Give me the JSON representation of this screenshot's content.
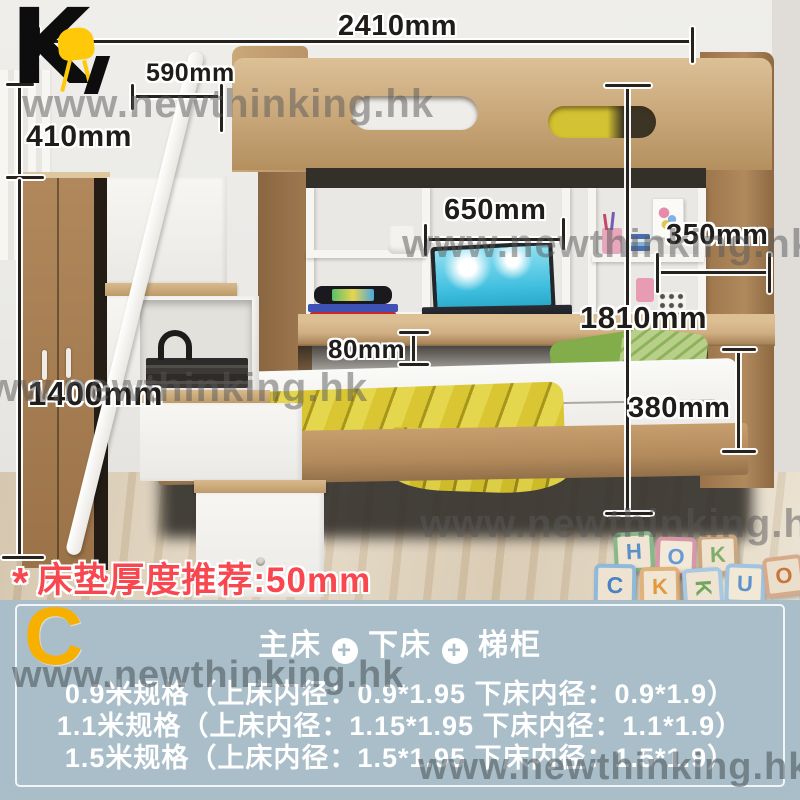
{
  "logo": {
    "letter": "K",
    "chair_icon": "yellow-chair-icon",
    "letter_color": "#0d0d0d",
    "chair_color": "#ffc808"
  },
  "watermark": {
    "text": "www.newthinking.hk",
    "color": "#585858"
  },
  "dimensions": {
    "total_width": "2410mm",
    "stair_depth": "590mm",
    "top_section_height": "410mm",
    "wardrobe_height": "1400mm",
    "desk_depth": "650mm",
    "shelf_depth": "350mm",
    "overall_height": "1810mm",
    "desk_thickness": "80mm",
    "lower_bed_clearance": "380mm"
  },
  "note": {
    "star": "*",
    "text": "床垫厚度推荐:50mm",
    "color": "#f8474e"
  },
  "panel": {
    "bg_color": "#a9bec9",
    "variant_letter": "C",
    "variant_color": "#f8b000",
    "header": {
      "items": [
        "主床",
        "下床",
        "梯柜"
      ],
      "plus": "+"
    },
    "specs": [
      "0.9米规格（上床内径：0.9*1.95 下床内径：0.9*1.9）",
      "1.1米规格（上床内径：1.15*1.95 下床内径：1.1*1.9）",
      "1.5米规格（上床内径：1.5*1.95 下床内径：1.5*1.9）"
    ]
  },
  "blocks": [
    {
      "letter": "H",
      "x": 614,
      "y": 532,
      "size": 40,
      "face": "#f0e5d2",
      "frame": "#86b889",
      "ink": "#5b8fc7",
      "rot": -3
    },
    {
      "letter": "O",
      "x": 656,
      "y": 537,
      "size": 40,
      "face": "#f3e9d8",
      "frame": "#d897a6",
      "ink": "#659bd4",
      "rot": 2
    },
    {
      "letter": "K",
      "x": 698,
      "y": 535,
      "size": 40,
      "face": "#efe3cf",
      "frame": "#caa77e",
      "ink": "#7fae6a",
      "rot": -2
    },
    {
      "letter": "C",
      "x": 594,
      "y": 564,
      "size": 42,
      "face": "#eee3d0",
      "frame": "#8fb9da",
      "ink": "#4a82c4",
      "rot": 1
    },
    {
      "letter": "K",
      "x": 640,
      "y": 567,
      "size": 40,
      "face": "#f1e6d3",
      "frame": "#e0b27c",
      "ink": "#e09a3f",
      "rot": -1
    },
    {
      "letter": "K",
      "x": 683,
      "y": 568,
      "size": 40,
      "face": "#efe4d1",
      "frame": "#a7c9e2",
      "ink": "#6fa85c",
      "rot": 86
    },
    {
      "letter": "U",
      "x": 725,
      "y": 564,
      "size": 40,
      "face": "#f2e8d6",
      "frame": "#9fc3e0",
      "ink": "#5d94cc",
      "rot": 2
    },
    {
      "letter": "O",
      "x": 764,
      "y": 556,
      "size": 40,
      "face": "#eadfcb",
      "frame": "#d8a98a",
      "ink": "#c8763f",
      "rot": -7
    }
  ]
}
